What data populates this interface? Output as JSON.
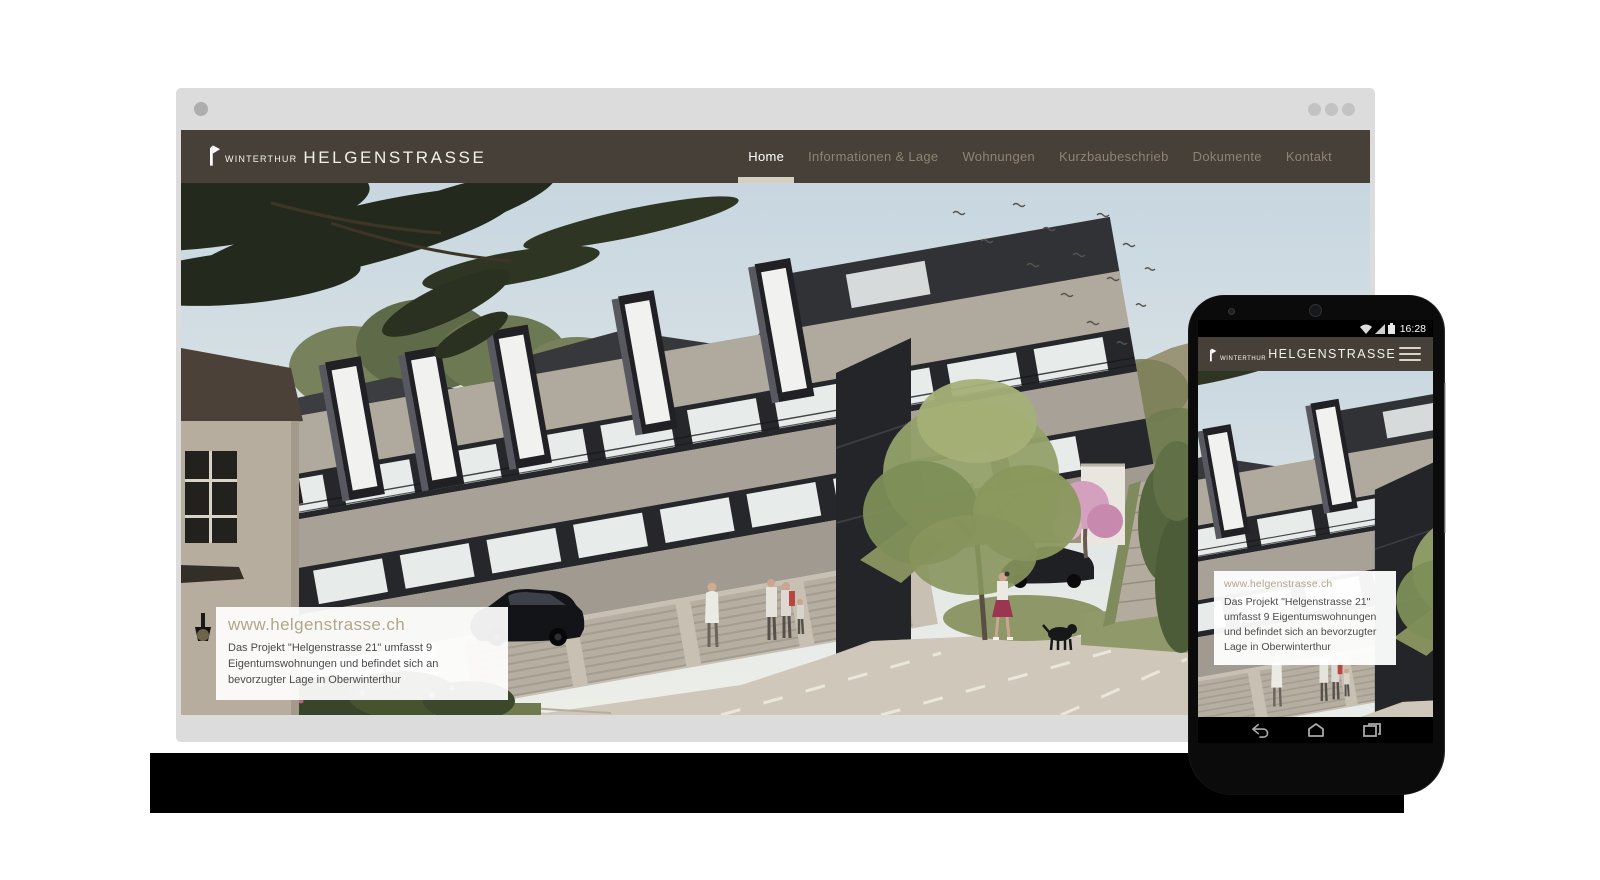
{
  "site": {
    "logo": {
      "pre": "WINTERTHUR",
      "main": "HELGENSTRASSE"
    },
    "nav": [
      {
        "label": "Home",
        "active": true
      },
      {
        "label": "Informationen & Lage",
        "active": false
      },
      {
        "label": "Wohnungen",
        "active": false
      },
      {
        "label": "Kurzbaubeschrieb",
        "active": false
      },
      {
        "label": "Dokumente",
        "active": false
      },
      {
        "label": "Kontakt",
        "active": false
      }
    ],
    "infobox": {
      "title": "www.helgenstrasse.ch",
      "body": "Das Projekt \"Helgenstrasse 21\" umfasst 9 Eigentumswohnungen und befindet sich an bevorzugter Lage in Oberwinterthur"
    }
  },
  "phone": {
    "status_time": "16:28",
    "status_icons": [
      "wifi-icon",
      "signal-icon",
      "battery-icon"
    ],
    "nav_buttons": [
      "back-icon",
      "home-icon",
      "recents-icon"
    ]
  },
  "colors": {
    "navbar": "#474039",
    "nav_link": "#8d8473",
    "nav_active": "#ffffff",
    "active_underline": "#d5cfc2",
    "infobox_title": "#b2a68a",
    "infobox_text": "#4a4a48",
    "browser_frame": "#dcdcdc",
    "shelf": "#000000"
  }
}
